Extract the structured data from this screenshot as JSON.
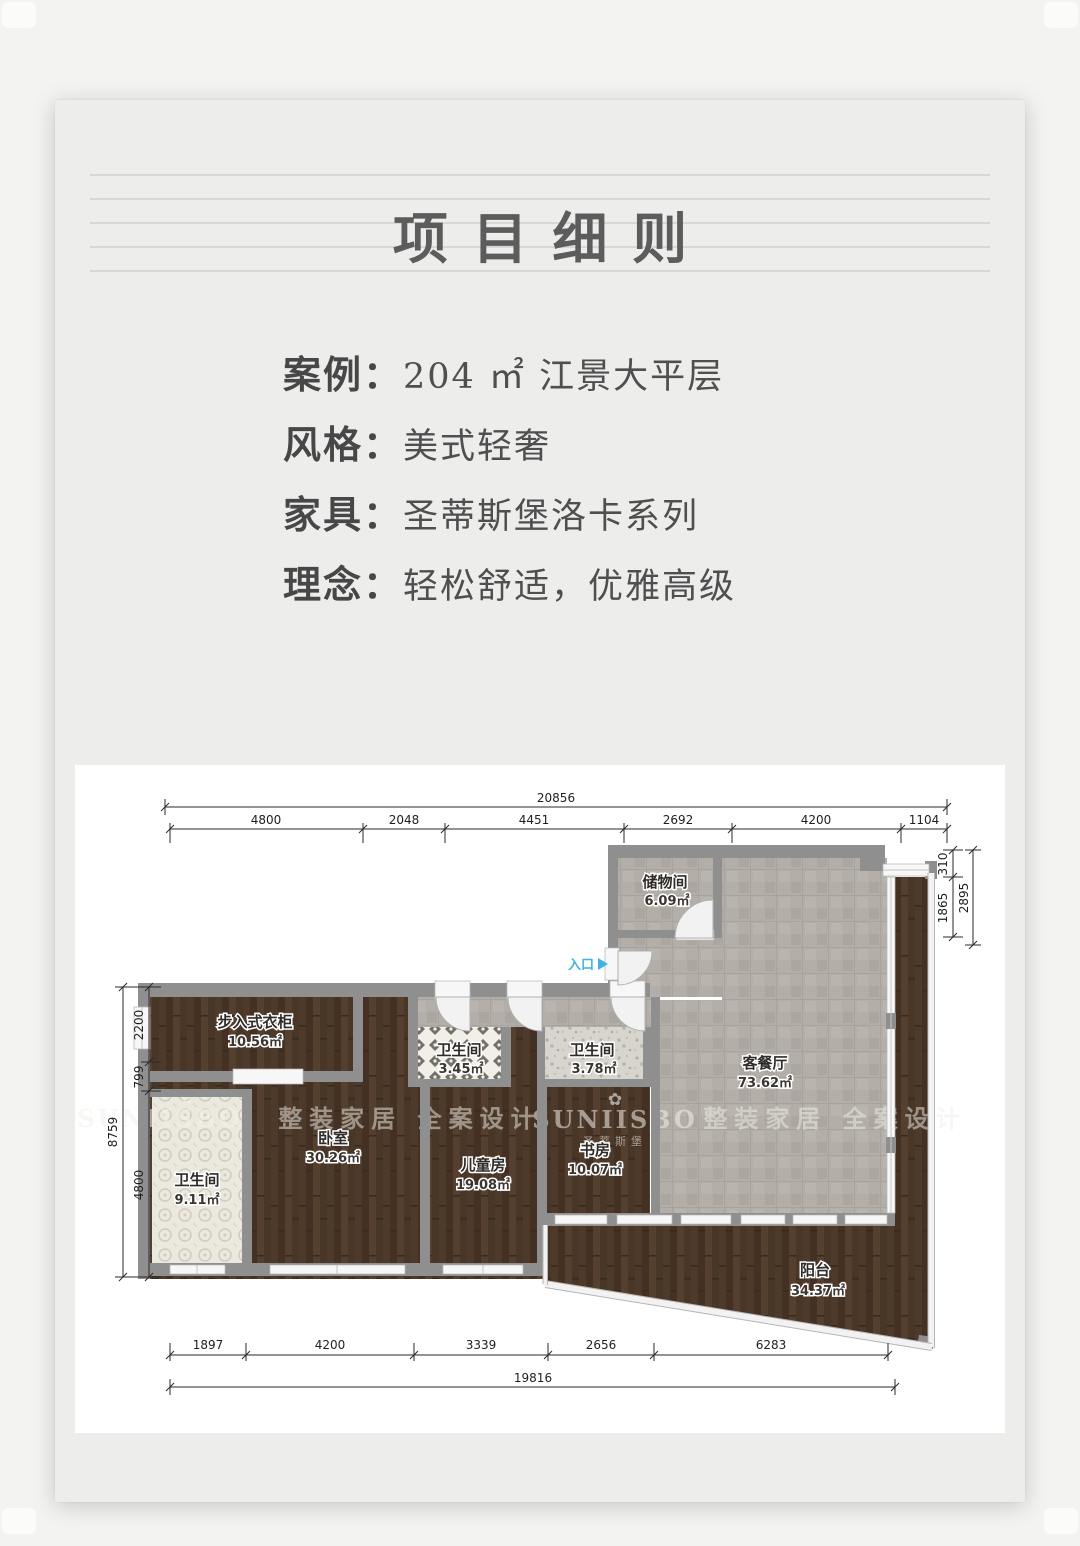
{
  "header": {
    "title": "项目细则"
  },
  "details": {
    "rows": [
      {
        "label": "案例：",
        "value": "204 ㎡ 江景大平层"
      },
      {
        "label": "风格：",
        "value": "美式轻奢"
      },
      {
        "label": "家具：",
        "value": "圣蒂斯堡洛卡系列"
      },
      {
        "label": "理念：",
        "value": "轻松舒适，优雅高级"
      }
    ]
  },
  "floorplan": {
    "entrance_label": "入口",
    "entrance_color": "#3fb3e3",
    "rooms": {
      "storage": {
        "name": "储物间",
        "area": "6.09㎡"
      },
      "living": {
        "name": "客餐厅",
        "area": "73.62㎡"
      },
      "closet": {
        "name": "步入式衣柜",
        "area": "10.56㎡"
      },
      "bedroom": {
        "name": "卧室",
        "area": "30.26㎡"
      },
      "bath_master": {
        "name": "卫生间",
        "area": "9.11㎡"
      },
      "bath_a": {
        "name": "卫生间",
        "area": "3.45㎡"
      },
      "bath_b": {
        "name": "卫生间",
        "area": "3.78㎡"
      },
      "kids": {
        "name": "儿童房",
        "area": "19.08㎡"
      },
      "study": {
        "name": "书房",
        "area": "10.07㎡"
      },
      "balcony": {
        "name": "阳台",
        "area": "34.37㎡"
      }
    },
    "dimensions": {
      "top_total": "20856",
      "top_segments": [
        "4800",
        "2048",
        "4451",
        "2692",
        "4200",
        "1104"
      ],
      "right_segments": [
        "310",
        "1865"
      ],
      "right_total": "2895",
      "left_segments": [
        "2200",
        "799",
        "4800"
      ],
      "left_total": "8759",
      "bottom_segments": [
        "1897",
        "4200",
        "3339",
        "2656",
        "6283"
      ],
      "bottom_total": "19816"
    },
    "watermark": {
      "brand": "SUNIISBO",
      "brand_cn": "圣蒂斯堡",
      "slogan": "整装家居 全案设计",
      "flower": "✿"
    }
  }
}
